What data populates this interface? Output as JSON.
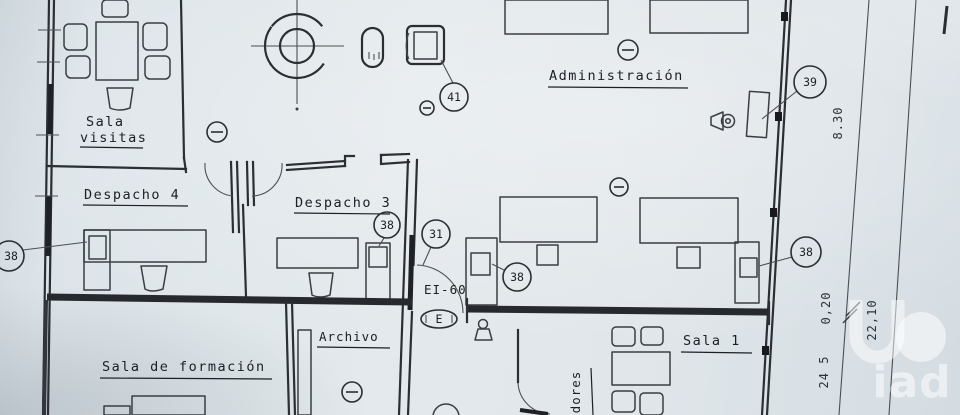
{
  "drawing": {
    "room_labels": {
      "sala_visitas_line1": "Sala",
      "sala_visitas_line2": "visitas",
      "despacho_4": "Despacho 4",
      "despacho_3": "Despacho 3",
      "administracion": "Administración",
      "archivo": "Archivo",
      "sala_formacion": "Sala de formación",
      "sala_1": "Sala 1",
      "partial_vertical": "dores"
    },
    "callouts": {
      "c41": "41",
      "c39": "39",
      "c31": "31",
      "c38_left": "38",
      "c38_despacho3": "38",
      "c38_sala1": "38",
      "c38_right": "38"
    },
    "door": {
      "rating": "EI-60",
      "extinguisher_mark": "E"
    },
    "dimensions": {
      "d830": "8.30",
      "d020": "0,20",
      "d2210": "22,10",
      "d245": "24 5"
    },
    "watermark": {
      "text": "iad"
    },
    "icons": {
      "fan": "ceiling-fan-icon",
      "detector": "circled-minus-detector-icon",
      "sounder": "alarm-sounder-icon",
      "extinguisher": "extinguisher-figure-icon",
      "shaft": "square-shaft-icon",
      "pill": "fixture-icon"
    },
    "colors": {
      "paper": "#dfe5e9",
      "ink": "#2b2e33",
      "watermark": "#ffffff"
    }
  }
}
